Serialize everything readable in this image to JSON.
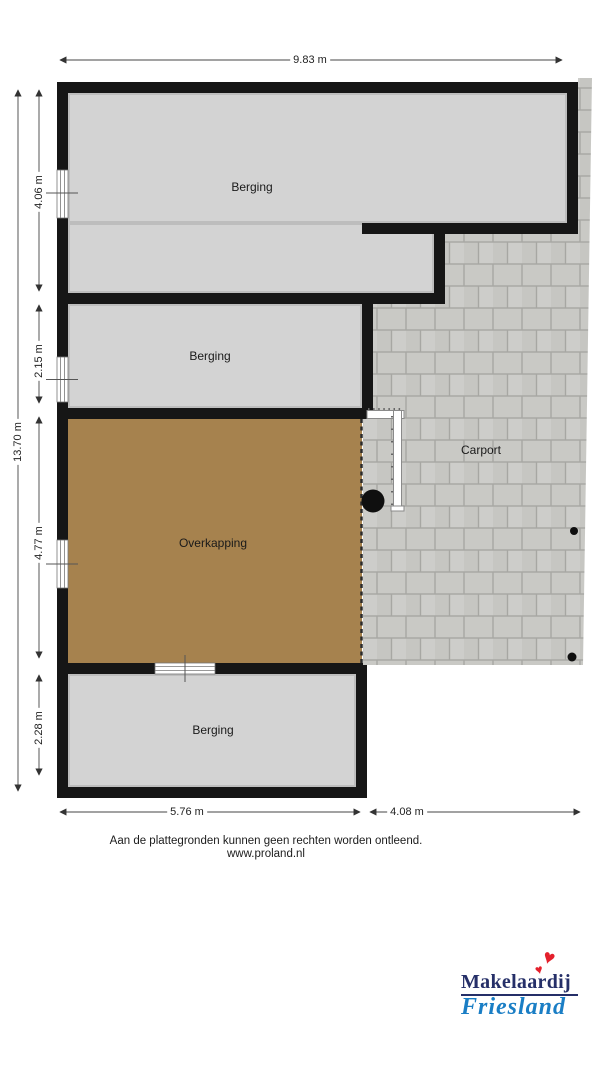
{
  "plan": {
    "rooms": [
      {
        "name": "berging-top",
        "label": "Berging"
      },
      {
        "name": "berging-middle",
        "label": "Berging"
      },
      {
        "name": "overkapping",
        "label": "Overkapping"
      },
      {
        "name": "carport",
        "label": "Carport"
      },
      {
        "name": "berging-bottom",
        "label": "Berging"
      }
    ],
    "dimensions": {
      "width_total": {
        "label": "9.83 m"
      },
      "height_total": {
        "label": "13.70 m"
      },
      "left_segments": [
        {
          "label": "4.06 m"
        },
        {
          "label": "2.15 m"
        },
        {
          "label": "4.77 m"
        },
        {
          "label": "2.28 m"
        }
      ],
      "bottom_segments": [
        {
          "label": "5.76 m"
        },
        {
          "label": "4.08 m"
        }
      ]
    },
    "colors": {
      "wall": "#161616",
      "room_fill": "#d3d3d3",
      "overkapping_fill": "#a6824e",
      "paving_fill": "#c9c9c5",
      "paving_joint": "#a7a7a3"
    }
  },
  "footer": {
    "disclaimer": "Aan de plattegronden kunnen geen rechten worden ontleend.",
    "website": "www.proland.nl"
  },
  "logo": {
    "line1": "Makelaardij",
    "line2": "Friesland",
    "heart": "♥",
    "line1_color": "#252f68",
    "line2_color": "#1a7ec5",
    "heart_color": "#e4202c"
  }
}
